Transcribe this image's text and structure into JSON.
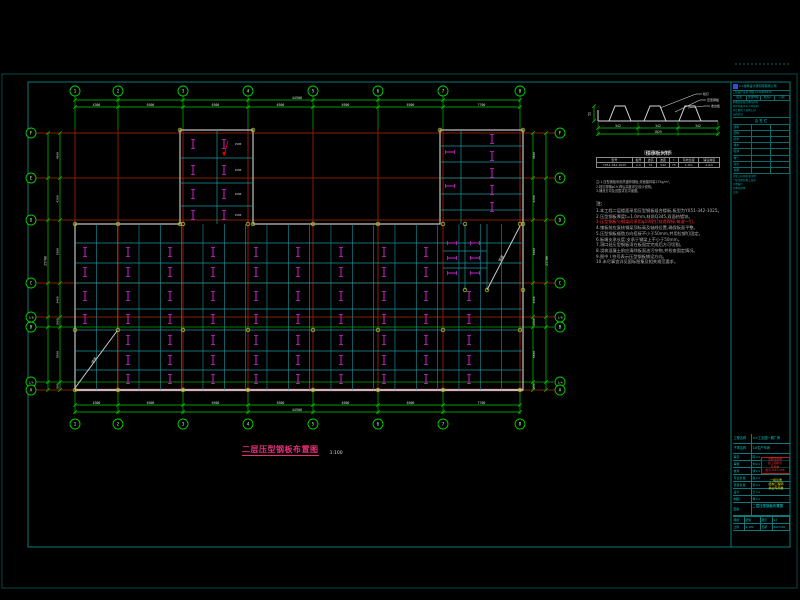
{
  "drawing_title": {
    "text": "二层压型钢板布置图",
    "scale": "1:100"
  },
  "colors": {
    "axis_red": "#b00000",
    "grid_green": "#00a800",
    "beam_cyan": "#1898a0",
    "outline_gray": "#c0c0c0",
    "symbol_magenta": "#cc22cc",
    "title_magenta": "#e8307a",
    "titleblock_cyan": "#00b8b8",
    "stamp_red": "#ff2828",
    "stamp_yellow": "#e8e810",
    "logo_blue": "#2b4fe0"
  },
  "grid": {
    "col_labels": [
      "1",
      "2",
      "3",
      "4",
      "5",
      "6",
      "7",
      "8"
    ],
    "row_labels": [
      "F",
      "E",
      "D",
      "C",
      "1/B",
      "B",
      "1/A",
      "A"
    ]
  },
  "dims": {
    "top": {
      "segments": [
        "4300",
        "6500",
        "6500",
        "6500",
        "6500",
        "6500",
        "7700"
      ],
      "total": "44500"
    },
    "bottom": {
      "segments": [
        "4300",
        "6500",
        "6500",
        "6500",
        "6500",
        "6500",
        "7700"
      ],
      "total": "44500"
    },
    "left": {
      "segments": [
        "4500",
        "4200",
        "6300",
        "3400",
        "1000",
        "5500",
        "800"
      ],
      "total": "25700"
    },
    "right": {
      "segments": [
        "4500",
        "4200",
        "6300",
        "3400",
        "1000",
        "5500",
        "800"
      ],
      "total": "25700"
    }
  },
  "plan": {
    "ramp_label": "坡道",
    "cell_label": "1500"
  },
  "detail": {
    "title": "楼承板大样",
    "left_dim": "51",
    "bottom_segments": [
      "342",
      "342",
      "342"
    ],
    "bottom_total": "1025",
    "leaders": [
      "栓钉",
      "压型钢板",
      "收边板"
    ],
    "table": {
      "title": "压型钢板参数表",
      "headers": [
        "型号",
        "板厚",
        "波高",
        "波距",
        "t",
        "有效宽度",
        "铺设跨度"
      ],
      "row": [
        "YX51-342-1025",
        "1.0",
        "51",
        "342",
        "75",
        "1.0m",
        "2.0m"
      ]
    },
    "notes": [
      "注:1.压型钢板采用热镀锌钢板,双面镀锌量275g/m²。",
      "2.栓钉规格φ19,焊后高度详见设计说明。",
      "3.铺设方向及范围详见平面图。"
    ]
  },
  "notes": {
    "title": "注:",
    "lines": [
      {
        "text": "1.本工程二层楼面采用压型钢板组合楼板,板型为YX51-342-1025。",
        "red": false
      },
      {
        "text": "2.压型钢板厚度t=1.0mm,材质Q345,双面热镀锌。",
        "red": false
      },
      {
        "text": "3.压型钢板与钢梁间采用φ19栓钉穿透焊接,每波一钉。",
        "red": true
      },
      {
        "text": "4.铺板前应复核钢梁顶标高及轴线位置,确保板面平整。",
        "red": false
      },
      {
        "text": "5.压型钢板顺肋方向搭接不小于50mm,并用拉铆钉固定。",
        "red": false
      },
      {
        "text": "6.板端支承长度:支承于钢梁上不小于50mm。",
        "red": false
      },
      {
        "text": "7.洞口处压型钢板须在板固定完成后方可切割。",
        "red": false
      },
      {
        "text": "8.浇筑混凝土前应清除板面油污杂物,并检查固定情况。",
        "red": false
      },
      {
        "text": "9.图中 Ⅰ 符号表示压型钢板铺设方向。",
        "red": false
      },
      {
        "text": "10.未尽事宜详见国标图集及相关规范要求。",
        "red": false
      }
    ]
  },
  "strip": {
    "company": "××建筑设计研究院有限公司",
    "cert": "工程设计证书 甲级 A132005678",
    "rev_headers": [
      "版次",
      "修改内容",
      "修改人",
      "日期"
    ],
    "policy_lines": [
      "本图纸版权归本院所有",
      "未经书面许可不得复制",
      "转让或用于其他工程",
      "违者必究"
    ],
    "sign_title": "会 签 栏",
    "sign_rows": [
      "建筑",
      "结构",
      "给水",
      "排水",
      "暖通",
      "电气",
      "动力",
      "总图"
    ],
    "stamp_lines": [
      "注册工程师执业印章",
      "一级注册结构工程师",
      "印章编号:",
      "出图专用章",
      "日期:"
    ]
  },
  "tblock": {
    "project_label": "工程名称",
    "project_value": "××工业园一期厂房",
    "sub_label": "子项名称",
    "sub_value": "1#生产车间",
    "rows": [
      [
        "审定",
        "陈××"
      ],
      [
        "审核",
        "刘××"
      ],
      [
        "校对",
        "张××"
      ],
      [
        "专业负责",
        "赵××"
      ],
      [
        "项目负责",
        "孙××"
      ],
      [
        "设计",
        "王××"
      ],
      [
        "制图",
        "李××"
      ]
    ],
    "red_stamp": [
      "出图专用章",
      "施工图审查",
      "专用章",
      "编号2023-058"
    ],
    "yellow_stamp": [
      "一级注册",
      "结构工程师",
      "执业专用章"
    ],
    "name_label": "图名",
    "name_value": "二层压型钢板布置图",
    "meta": [
      [
        "图别",
        "结施"
      ],
      [
        "图号",
        "12"
      ],
      [
        "比例",
        "1:100"
      ],
      [
        "日期",
        "2023.06"
      ]
    ]
  }
}
